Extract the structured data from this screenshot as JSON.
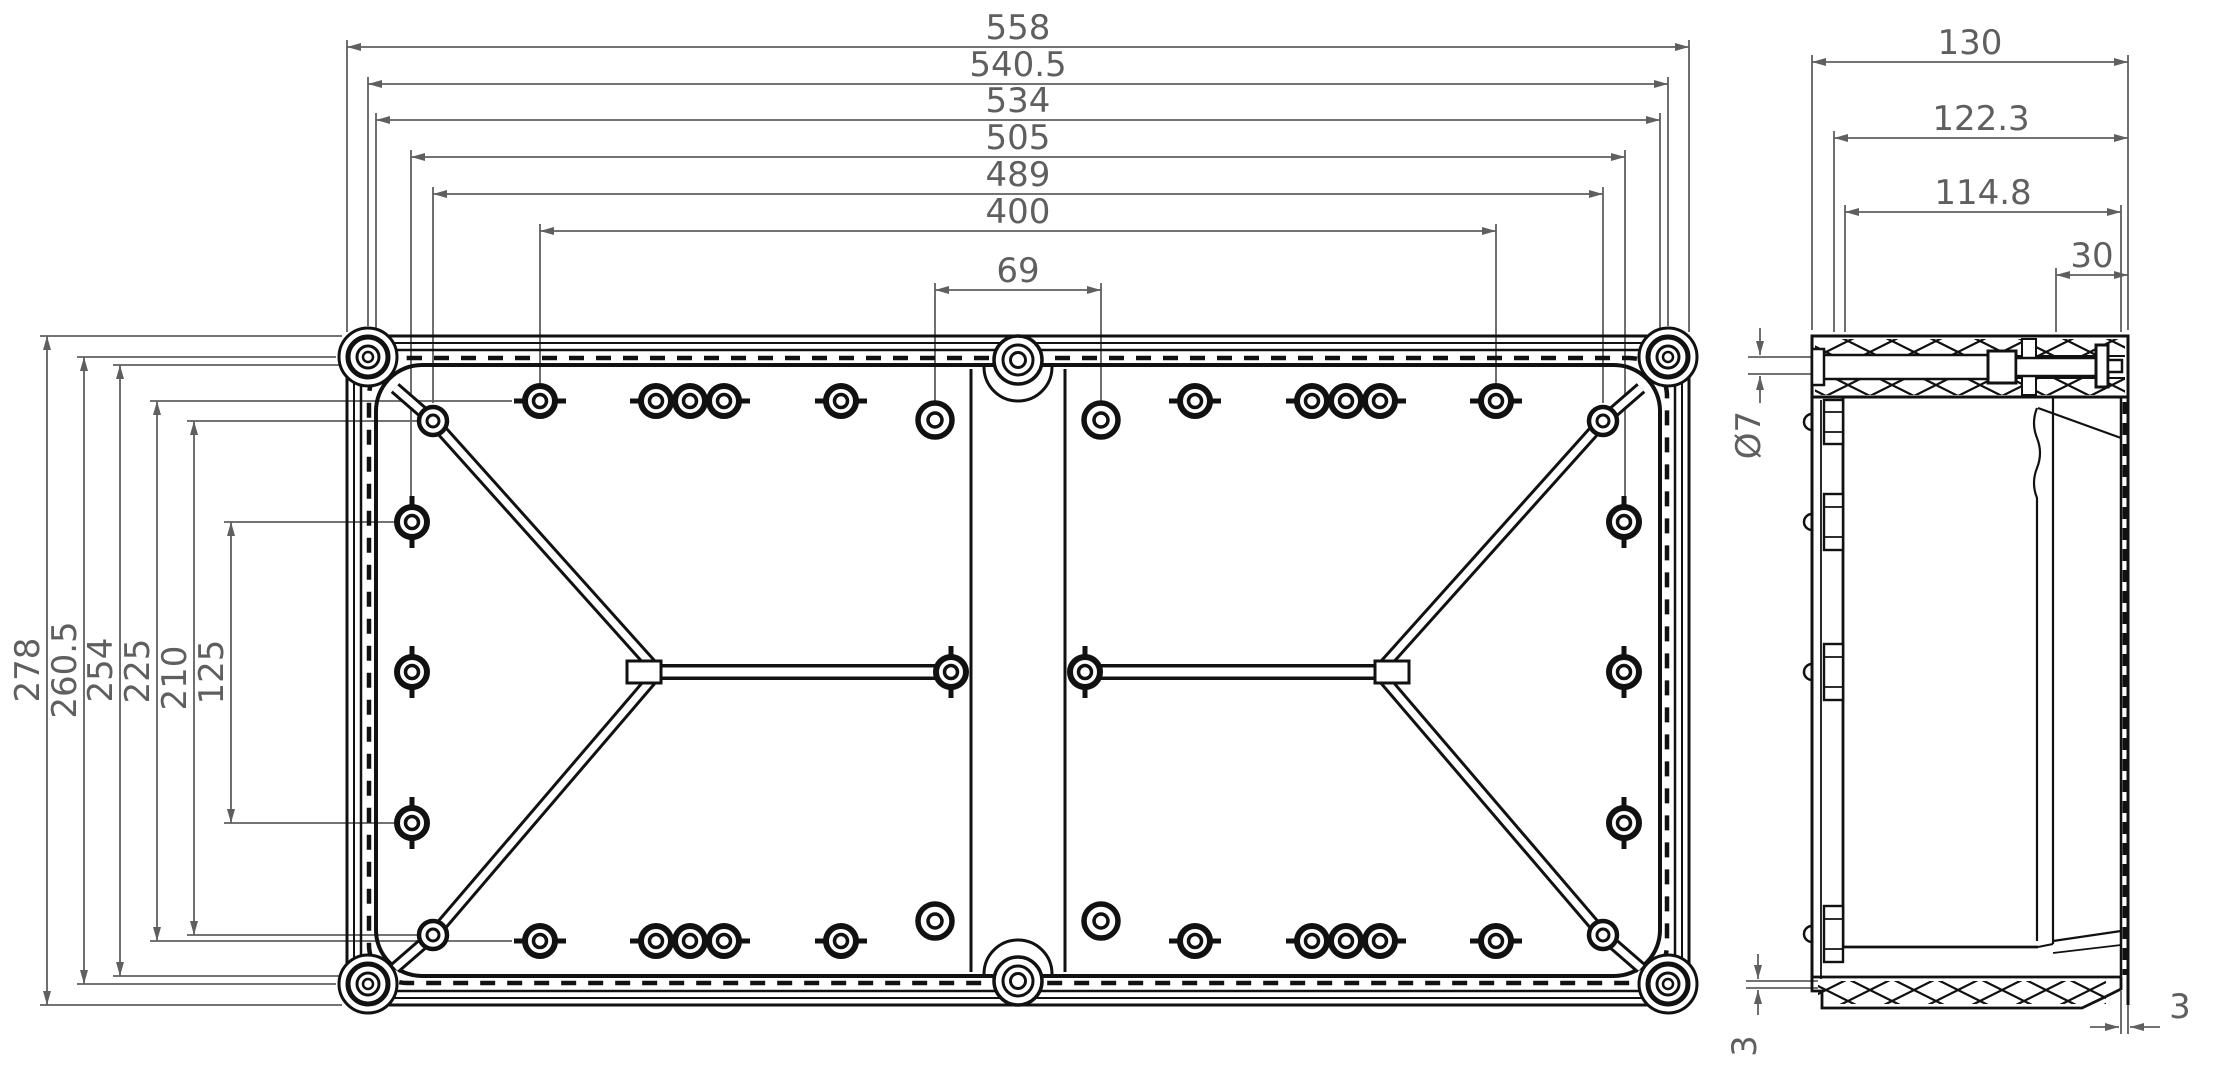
{
  "plan_view": {
    "top_dims": [
      "558",
      "540.5",
      "534",
      "505",
      "489",
      "400",
      "69"
    ],
    "left_dims": [
      "278",
      "260.5",
      "254",
      "225",
      "210",
      "125"
    ]
  },
  "side_view": {
    "width_dims": [
      "130",
      "122.3",
      "114.8",
      "30"
    ],
    "hole_diameter": "Ø7",
    "base_step_left": "3",
    "wall_thickness_right": "3"
  },
  "colors": {
    "line": "#111111",
    "dim": "#5f5f5f",
    "bg": "#ffffff"
  }
}
